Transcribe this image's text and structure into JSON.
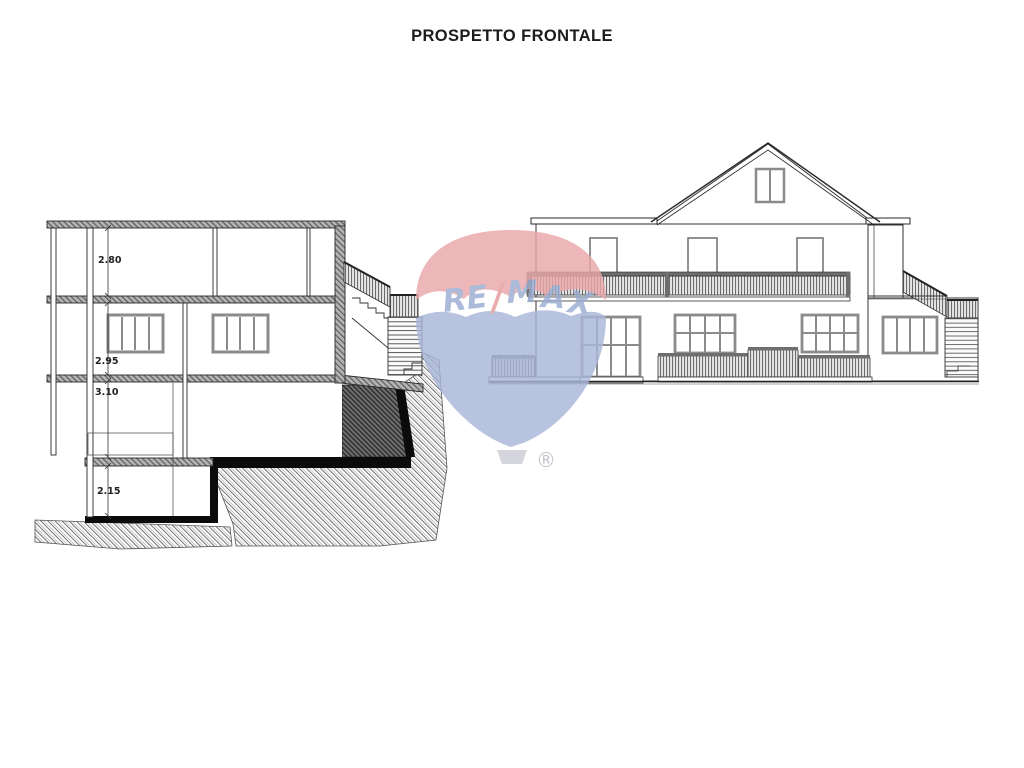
{
  "title": "PROSPETTO FRONTALE",
  "section": {
    "name": "building cross section",
    "dims": {
      "d1": "2.80",
      "d2": "2.95",
      "d3": "3.10",
      "d4": "2.15"
    }
  },
  "elevation": {
    "name": "front elevation of house"
  },
  "watermark": {
    "re": "RE",
    "slash": "/",
    "m": "M",
    "a": "A",
    "x": "X",
    "registered": "®",
    "colors": {
      "balloon_red": "#eaa7a9",
      "balloon_blue": "#a9b6d8",
      "text_blue": "#9badd2",
      "slash_red": "#e39a9d",
      "basket_gray": "#cdced6",
      "registered_gray": "#b9b9c1"
    }
  }
}
